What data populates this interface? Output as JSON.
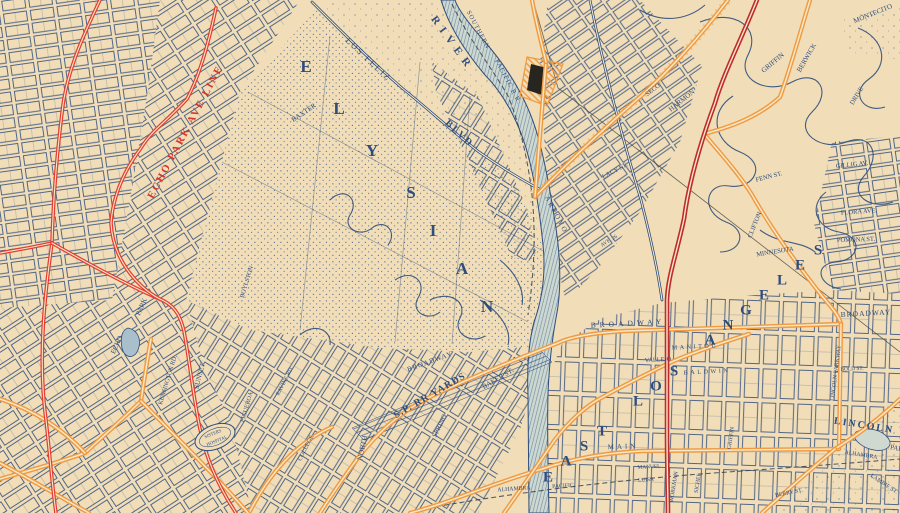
{
  "palette": {
    "cream": "#f1deb8",
    "cream2": "#f6e8c8",
    "ink": "#2e4c7c",
    "red": "#e23f33",
    "red_dark": "#bf2c2c",
    "red_text": "#d2342b",
    "orange": "#f09a42",
    "river_fill": "#ccd8d0",
    "rail": "#3a3f4a",
    "boundary": "#42403a",
    "building": "#26251f"
  },
  "labels": [
    {
      "n": "echo-park-ave-line",
      "t": "ECHO PARK AVE LINE",
      "x": 186,
      "y": 132,
      "r": -62,
      "s": 10.5,
      "c": "red",
      "ls": 2,
      "b": true
    },
    {
      "n": "river",
      "t": "RIVER",
      "x": 452,
      "y": 44,
      "r": 54,
      "s": 11,
      "ls": 6,
      "b": true
    },
    {
      "n": "los-feliz",
      "t": "LOS FELIZ",
      "x": 368,
      "y": 60,
      "r": 43,
      "s": 8.5,
      "ls": 2
    },
    {
      "n": "blvd",
      "t": "BLVD",
      "x": 459,
      "y": 134,
      "r": 43,
      "s": 10,
      "ls": 2,
      "b": true
    },
    {
      "n": "southern",
      "t": "SOUTHERN",
      "x": 478,
      "y": 30,
      "r": 62,
      "s": 6.5,
      "ls": 1
    },
    {
      "n": "pacific-rr",
      "t": "PACIFIC R.R.",
      "x": 508,
      "y": 82,
      "r": 62,
      "s": 6.5,
      "ls": 1
    },
    {
      "n": "elysian-e",
      "t": "E",
      "x": 306,
      "y": 68,
      "s": 17,
      "b": true
    },
    {
      "n": "elysian-l",
      "t": "L",
      "x": 339,
      "y": 110,
      "s": 17,
      "b": true
    },
    {
      "n": "elysian-y",
      "t": "Y",
      "x": 372,
      "y": 152,
      "s": 17,
      "b": true
    },
    {
      "n": "elysian-s",
      "t": "S",
      "x": 411,
      "y": 194,
      "s": 17,
      "b": true
    },
    {
      "n": "elysian-i",
      "t": "I",
      "x": 433,
      "y": 232,
      "s": 17,
      "b": true
    },
    {
      "n": "elysian-a",
      "t": "A",
      "x": 462,
      "y": 270,
      "s": 17,
      "b": true
    },
    {
      "n": "elysian-n",
      "t": "N",
      "x": 487,
      "y": 308,
      "s": 17,
      "b": true
    },
    {
      "n": "sp-rr-yards",
      "t": "S.P. RR YARDS",
      "x": 430,
      "y": 396,
      "r": -30,
      "s": 10,
      "b": true,
      "ls": 1
    },
    {
      "n": "baker-st",
      "t": "BAKER ST.",
      "x": 498,
      "y": 379,
      "r": -30,
      "s": 7
    },
    {
      "n": "broadway-west",
      "t": "BROADWAY",
      "x": 430,
      "y": 362,
      "r": -20,
      "s": 7,
      "ls": 1
    },
    {
      "n": "north-st",
      "t": "NORTH",
      "x": 363,
      "y": 448,
      "r": -78,
      "s": 7.5
    },
    {
      "n": "spring-st",
      "t": "SPRING",
      "x": 440,
      "y": 426,
      "r": -64,
      "s": 7
    },
    {
      "n": "broadway-center",
      "t": "BROADWAY",
      "x": 628,
      "y": 324,
      "r": -3,
      "s": 7.5,
      "ls": 4
    },
    {
      "n": "broadway-east",
      "t": "BROADWAY",
      "x": 866,
      "y": 314,
      "r": -3,
      "s": 7.5,
      "ls": 1
    },
    {
      "n": "ela-e1",
      "t": "E",
      "x": 548,
      "y": 478,
      "s": 15,
      "b": true
    },
    {
      "n": "ela-a1",
      "t": "A",
      "x": 566,
      "y": 462,
      "s": 15,
      "b": true
    },
    {
      "n": "ela-s1",
      "t": "S",
      "x": 584,
      "y": 447,
      "s": 15,
      "b": true
    },
    {
      "n": "ela-t1",
      "t": "T",
      "x": 602,
      "y": 432,
      "s": 15,
      "b": true
    },
    {
      "n": "ela-l1",
      "t": "L",
      "x": 638,
      "y": 402,
      "s": 15,
      "b": true
    },
    {
      "n": "ela-o1",
      "t": "O",
      "x": 656,
      "y": 387,
      "s": 15,
      "b": true
    },
    {
      "n": "ela-s2",
      "t": "S",
      "x": 674,
      "y": 372,
      "s": 15,
      "b": true
    },
    {
      "n": "ela-a2",
      "t": "A",
      "x": 710,
      "y": 341,
      "s": 15,
      "b": true
    },
    {
      "n": "ela-n1",
      "t": "N",
      "x": 728,
      "y": 326,
      "s": 15,
      "b": true
    },
    {
      "n": "ela-g1",
      "t": "G",
      "x": 746,
      "y": 311,
      "s": 15,
      "b": true
    },
    {
      "n": "ela-e2",
      "t": "E",
      "x": 764,
      "y": 296,
      "s": 15,
      "b": true
    },
    {
      "n": "ela-l2",
      "t": "L",
      "x": 782,
      "y": 281,
      "s": 15,
      "b": true
    },
    {
      "n": "ela-e3",
      "t": "E",
      "x": 800,
      "y": 266,
      "s": 15,
      "b": true
    },
    {
      "n": "ela-s3",
      "t": "S",
      "x": 818,
      "y": 251,
      "s": 15,
      "b": true
    },
    {
      "n": "lincoln",
      "t": "LINCOLN",
      "x": 864,
      "y": 426,
      "r": 9,
      "s": 10,
      "b": true,
      "ls": 2
    },
    {
      "n": "lincoln-park",
      "t": "PARK",
      "x": 899,
      "y": 449,
      "r": 9,
      "s": 7
    },
    {
      "n": "alhambra-east",
      "t": "ALHAMBRA",
      "x": 861,
      "y": 455,
      "r": 9,
      "s": 5.8
    },
    {
      "n": "alhambra-rail",
      "t": "ALHAMBRA",
      "x": 514,
      "y": 489,
      "r": -4,
      "s": 5.8
    },
    {
      "n": "pacific-rail",
      "t": "PACIFIC",
      "x": 563,
      "y": 486,
      "r": -4,
      "s": 5.8
    },
    {
      "n": "sunset",
      "t": "SUNSET",
      "x": 200,
      "y": 376,
      "r": -76,
      "s": 7
    },
    {
      "n": "kensington",
      "t": "KENSINGTON RD.",
      "x": 168,
      "y": 380,
      "r": -73,
      "s": 6.2
    },
    {
      "n": "sisters",
      "t": "SISTERS",
      "x": 213,
      "y": 434,
      "r": -22,
      "s": 4.6
    },
    {
      "n": "hospital",
      "t": "HOSPITAL",
      "x": 217,
      "y": 441,
      "r": -22,
      "s": 4.6
    },
    {
      "n": "figueroa",
      "t": "FIGUEROA",
      "x": 247,
      "y": 407,
      "r": -74,
      "s": 6.2
    },
    {
      "n": "harmon",
      "t": "HARMON",
      "x": 682,
      "y": 101,
      "r": -38,
      "s": 7
    },
    {
      "n": "griffin-hills",
      "t": "GRIFFIN",
      "x": 773,
      "y": 63,
      "r": -40,
      "s": 7
    },
    {
      "n": "berwick",
      "t": "BERWICK",
      "x": 807,
      "y": 58,
      "r": -60,
      "s": 7
    },
    {
      "n": "montecito",
      "t": "MONTECITO",
      "x": 873,
      "y": 14,
      "r": -22,
      "s": 7
    },
    {
      "n": "drive",
      "t": "DRIVE",
      "x": 857,
      "y": 96,
      "r": -58,
      "s": 6.5
    },
    {
      "n": "fenn",
      "t": "FENN ST.",
      "x": 769,
      "y": 177,
      "r": -14,
      "s": 6.5
    },
    {
      "n": "clifton",
      "t": "CLIFTON",
      "x": 755,
      "y": 225,
      "r": -68,
      "s": 6.5
    },
    {
      "n": "minnesota",
      "t": "MINNESOTA",
      "x": 775,
      "y": 252,
      "r": -9,
      "s": 6.5
    },
    {
      "n": "flora",
      "t": "FLORA AVE.",
      "x": 859,
      "y": 212,
      "r": -4,
      "s": 6.5
    },
    {
      "n": "pomona",
      "t": "POMONA ST.",
      "x": 856,
      "y": 240,
      "r": -2,
      "s": 6.5
    },
    {
      "n": "gillig",
      "t": "GILLIG AV.",
      "x": 852,
      "y": 165,
      "r": -6,
      "s": 6.5
    },
    {
      "n": "vallejo",
      "t": "VALLEJO",
      "x": 658,
      "y": 360,
      "r": -3,
      "s": 6.2
    },
    {
      "n": "manitou",
      "t": "MANITOU",
      "x": 695,
      "y": 347,
      "r": -3,
      "s": 6.2,
      "ls": 2.5
    },
    {
      "n": "baldwin",
      "t": "BALDWIN",
      "x": 707,
      "y": 372,
      "r": -3,
      "s": 6.2,
      "ls": 2.5
    },
    {
      "n": "lincoln-parkway",
      "t": "LINCOLN PARKWAY",
      "x": 836,
      "y": 373,
      "r": -83,
      "s": 6
    },
    {
      "n": "workman",
      "t": "WORKMAN",
      "x": 674,
      "y": 487,
      "r": -81,
      "s": 5.8
    },
    {
      "n": "sichel",
      "t": "SICHEL",
      "x": 698,
      "y": 483,
      "r": -81,
      "s": 5.8
    },
    {
      "n": "griffin-lh",
      "t": "GRIFFIN",
      "x": 731,
      "y": 438,
      "r": -81,
      "s": 5.8
    },
    {
      "n": "main",
      "t": "MAIN",
      "x": 623,
      "y": 447,
      "r": -2,
      "s": 7,
      "ls": 3
    },
    {
      "n": "manuel",
      "t": "MANUEL",
      "x": 649,
      "y": 467,
      "r": -3,
      "s": 5.4
    },
    {
      "n": "luisa",
      "t": "LUISA",
      "x": 646,
      "y": 480,
      "r": -3,
      "s": 5.4
    },
    {
      "n": "berry",
      "t": "BERRY ST.",
      "x": 789,
      "y": 493,
      "r": -11,
      "s": 5.8
    },
    {
      "n": "lambie",
      "t": "LAMBIE ST.",
      "x": 884,
      "y": 484,
      "r": 33,
      "s": 5.8
    },
    {
      "n": "college",
      "t": "COLLEGE",
      "x": 306,
      "y": 448,
      "r": -63,
      "s": 6.2
    },
    {
      "n": "lacy",
      "t": "LACY ST.",
      "x": 615,
      "y": 171,
      "r": -28,
      "s": 6.5
    },
    {
      "n": "arroyo",
      "t": "ARROYO",
      "x": 556,
      "y": 215,
      "r": 62,
      "s": 7,
      "ls": 2
    },
    {
      "n": "seco",
      "t": "SECO",
      "x": 653,
      "y": 90,
      "r": -38,
      "s": 6.5
    },
    {
      "n": "park-echo",
      "t": "PARK",
      "x": 142,
      "y": 307,
      "r": -66,
      "s": 7
    },
    {
      "n": "echo",
      "t": "ECHO",
      "x": 117,
      "y": 345,
      "r": -66,
      "s": 7
    },
    {
      "n": "boylston",
      "t": "BOYLSTON",
      "x": 247,
      "y": 282,
      "r": -73,
      "s": 6.2
    },
    {
      "n": "baxter",
      "t": "BAXTER",
      "x": 304,
      "y": 113,
      "r": -34,
      "s": 7
    },
    {
      "n": "ravine",
      "t": "RAVINE RD.",
      "x": 285,
      "y": 381,
      "r": -63,
      "s": 5.8
    },
    {
      "n": "ave-26",
      "t": "AVE. 26",
      "x": 609,
      "y": 241,
      "r": -32,
      "s": 5.4
    },
    {
      "n": "bold-st",
      "t": "BOLD ST.",
      "x": 852,
      "y": 369,
      "r": -3,
      "s": 5.4
    }
  ]
}
